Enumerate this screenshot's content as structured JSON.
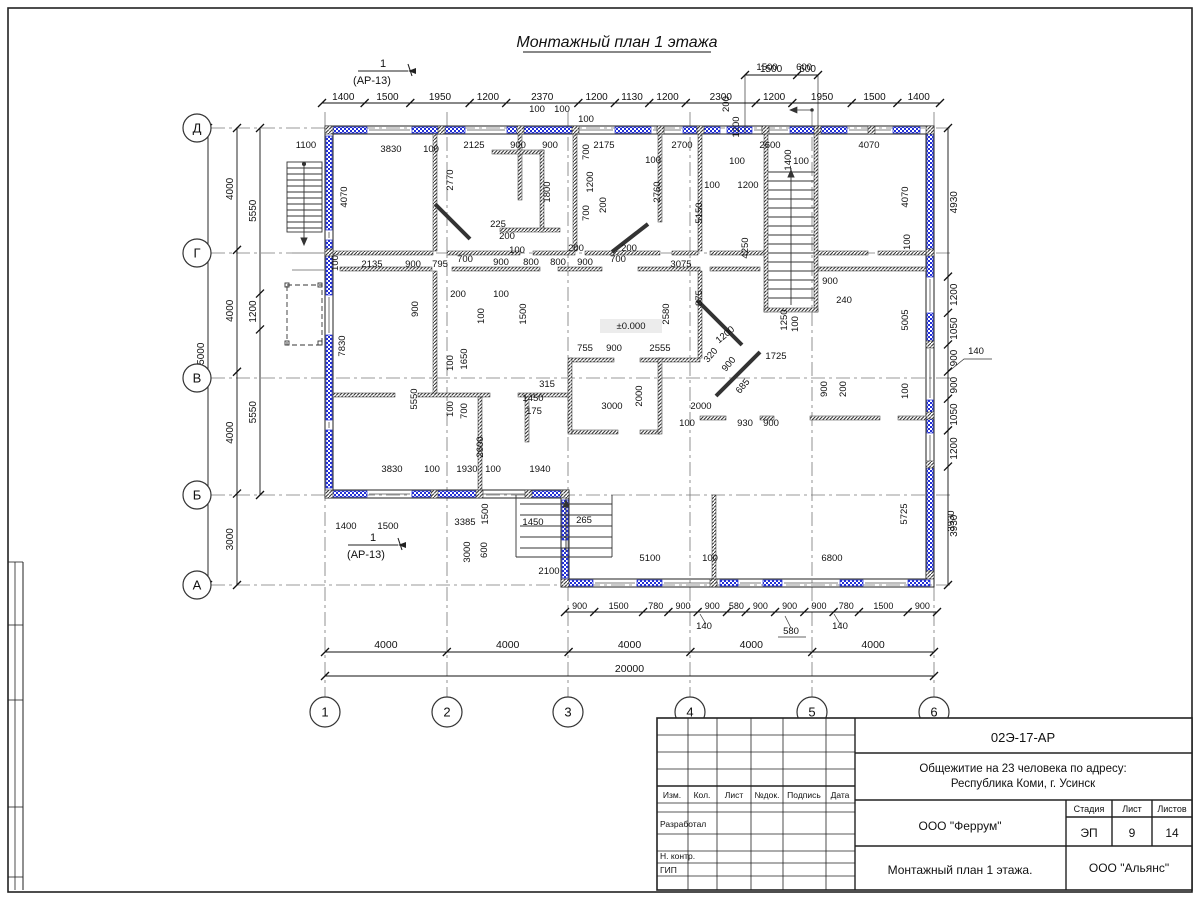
{
  "sheet": {
    "main_title": "Монтажный план 1 этажа"
  },
  "colors": {
    "panel_blue": "#2331d6",
    "wall_dark": "#333333",
    "paper": "#ffffff"
  },
  "section_markers": {
    "number": "1",
    "reference": "(АР-13)"
  },
  "axes": {
    "row_labels": [
      "Д",
      "Г",
      "В",
      "Б",
      "А"
    ],
    "col_labels": [
      "1",
      "2",
      "3",
      "4",
      "5",
      "6"
    ]
  },
  "dims": {
    "chains": {
      "top": [
        "1400",
        "1500",
        "1950",
        "1200",
        "2370",
        "1200",
        "1130",
        "1200",
        "2300",
        "1200",
        "1950",
        "1500",
        "1400"
      ],
      "top_aux": [
        "1500",
        "600"
      ],
      "left_total": [
        "15000"
      ],
      "left_main": [
        "4000",
        "4000",
        "4000",
        "3000"
      ],
      "left_inner": [
        "5550",
        "1200",
        "5550"
      ],
      "right": [
        "4930",
        "1200",
        "1050",
        "900",
        "900",
        "1050",
        "1200",
        "3930"
      ],
      "bottom_sub": [
        "900",
        "1500",
        "780",
        "900",
        "900",
        "580",
        "900",
        "900",
        "900",
        "780",
        "1500",
        "900"
      ],
      "bottom_main": [
        "4000",
        "4000",
        "4000",
        "4000",
        "4000"
      ],
      "bottom_total": [
        "20000"
      ]
    },
    "level_mark": "±0.000",
    "floating": [
      [
        "1500",
        767,
        70
      ],
      [
        "600",
        804,
        70
      ],
      [
        "200",
        729,
        104,
        -90
      ],
      [
        "1200",
        739,
        127,
        -90
      ],
      [
        "100",
        537,
        112
      ],
      [
        "100",
        562,
        112
      ],
      [
        "100",
        586,
        122
      ],
      [
        "1100",
        306,
        148
      ],
      [
        "3830",
        391,
        152
      ],
      [
        "100",
        431,
        152
      ],
      [
        "2125",
        474,
        148
      ],
      [
        "900",
        518,
        148
      ],
      [
        "900",
        550,
        148
      ],
      [
        "2175",
        604,
        148
      ],
      [
        "2700",
        682,
        148
      ],
      [
        "2600",
        770,
        148
      ],
      [
        "4070",
        869,
        148
      ],
      [
        "100",
        737,
        164
      ],
      [
        "100",
        801,
        164
      ],
      [
        "1400",
        791,
        160,
        -90
      ],
      [
        "100",
        712,
        188
      ],
      [
        "1200",
        748,
        188
      ],
      [
        "4070",
        347,
        197,
        -90
      ],
      [
        "2770",
        453,
        180,
        -90
      ],
      [
        "1800",
        550,
        192,
        -90
      ],
      [
        "700",
        589,
        152,
        -90
      ],
      [
        "1200",
        593,
        182,
        -90
      ],
      [
        "700",
        589,
        213,
        -90
      ],
      [
        "200",
        606,
        205,
        -90
      ],
      [
        "100",
        653,
        163
      ],
      [
        "2760",
        660,
        192,
        -90
      ],
      [
        "5150",
        702,
        213,
        -90
      ],
      [
        "4250",
        748,
        248,
        -90
      ],
      [
        "4070",
        908,
        197,
        -90
      ],
      [
        "100",
        910,
        242,
        -90
      ],
      [
        "5005",
        908,
        320,
        -90
      ],
      [
        "225",
        498,
        227
      ],
      [
        "200",
        507,
        239
      ],
      [
        "100",
        517,
        253
      ],
      [
        "100",
        338,
        263,
        -90
      ],
      [
        "2135",
        372,
        267
      ],
      [
        "900",
        413,
        267
      ],
      [
        "795",
        440,
        267
      ],
      [
        "700",
        465,
        262
      ],
      [
        "900",
        501,
        265
      ],
      [
        "800",
        531,
        265
      ],
      [
        "800",
        558,
        265
      ],
      [
        "900",
        585,
        265
      ],
      [
        "700",
        618,
        262
      ],
      [
        "3075",
        681,
        267
      ],
      [
        "200",
        576,
        251
      ],
      [
        "200",
        629,
        251
      ],
      [
        "200",
        458,
        297
      ],
      [
        "100",
        501,
        297
      ],
      [
        "900",
        418,
        309,
        -90
      ],
      [
        "100",
        484,
        316,
        -90
      ],
      [
        "1500",
        526,
        314,
        -90
      ],
      [
        "875",
        702,
        298,
        -90
      ],
      [
        "1200",
        727,
        337,
        -40
      ],
      [
        "320",
        713,
        357,
        -50
      ],
      [
        "900",
        731,
        366,
        -50
      ],
      [
        "685",
        745,
        388,
        -50
      ],
      [
        "1725",
        776,
        359
      ],
      [
        "1250",
        787,
        320,
        -90
      ],
      [
        "100",
        798,
        324,
        -90
      ],
      [
        "900",
        830,
        284
      ],
      [
        "240",
        844,
        303
      ],
      [
        "900",
        827,
        389,
        -90
      ],
      [
        "200",
        846,
        389,
        -90
      ],
      [
        "100",
        908,
        391,
        -90
      ],
      [
        "±0.000",
        631,
        329
      ],
      [
        "2580",
        669,
        314,
        -90
      ],
      [
        "755",
        585,
        351
      ],
      [
        "900",
        614,
        351
      ],
      [
        "2555",
        660,
        351
      ],
      [
        "7830",
        345,
        346,
        -90
      ],
      [
        "5550",
        417,
        399,
        -90
      ],
      [
        "100",
        453,
        363,
        -90
      ],
      [
        "1650",
        467,
        359,
        -90
      ],
      [
        "100",
        453,
        409,
        -90
      ],
      [
        "700",
        467,
        411,
        -90
      ],
      [
        "315",
        547,
        387
      ],
      [
        "1450",
        533,
        401
      ],
      [
        "175",
        534,
        414
      ],
      [
        "2600",
        483,
        447,
        -90
      ],
      [
        "3000",
        612,
        409
      ],
      [
        "2000",
        642,
        396,
        -90
      ],
      [
        "2000",
        701,
        409
      ],
      [
        "100",
        687,
        426
      ],
      [
        "930",
        745,
        426
      ],
      [
        "900",
        771,
        426
      ],
      [
        "3830",
        392,
        472
      ],
      [
        "100",
        432,
        472
      ],
      [
        "1930",
        467,
        472
      ],
      [
        "100",
        493,
        472
      ],
      [
        "1940",
        540,
        472
      ],
      [
        "1400",
        346,
        529
      ],
      [
        "1500",
        388,
        529
      ],
      [
        "3385",
        465,
        525
      ],
      [
        "1500",
        488,
        514,
        -90
      ],
      [
        "1450",
        533,
        525
      ],
      [
        "265",
        584,
        523
      ],
      [
        "3000",
        470,
        552,
        -90
      ],
      [
        "600",
        487,
        550,
        -90
      ],
      [
        "2100",
        549,
        574
      ],
      [
        "5100",
        650,
        561
      ],
      [
        "100",
        710,
        561
      ],
      [
        "6800",
        832,
        561
      ],
      [
        "5725",
        907,
        514,
        -90
      ],
      [
        "3930",
        954,
        521,
        -90
      ],
      [
        "140",
        976,
        354
      ],
      [
        "140",
        704,
        629
      ],
      [
        "580",
        791,
        634
      ],
      [
        "140",
        840,
        629
      ]
    ]
  },
  "title_block": {
    "doc_number": "02Э-17-АР",
    "project_line1": "Общежитие на 23 человека по адресу:",
    "project_line2": "Республика Коми, г. Усинск",
    "designer_org": "ООО \"Феррум\"",
    "stage_label": "Стадия",
    "sheet_label": "Лист",
    "sheets_label": "Листов",
    "stage": "ЭП",
    "sheet": "9",
    "sheets": "14",
    "drawing_name": "Монтажный план 1 этажа.",
    "contractor_org": "ООО \"Альянс\"",
    "col_headers": [
      "Изм.",
      "Кол.",
      "Лист",
      "№док.",
      "Подпись",
      "Дата"
    ],
    "row_labels": [
      "Разработал",
      "Н. контр.",
      "ГИП"
    ]
  }
}
